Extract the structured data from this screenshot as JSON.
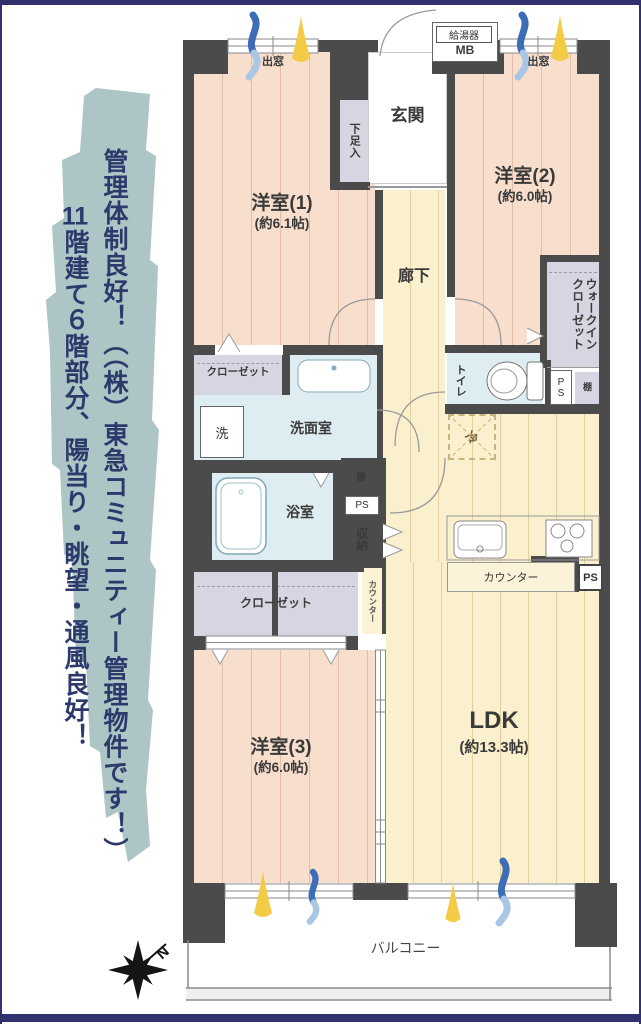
{
  "ad": {
    "line1": "管理体制良好！（（株）東急コミュニティー管理物件です！）",
    "line2_prefix": "11",
    "line2": "階建て６階部分、陽当り・眺望・通風良好！"
  },
  "plan": {
    "bay_window_left": "出窓",
    "bay_window_right": "出窓",
    "water_heater": "給湯器",
    "meter_box": "MB",
    "entrance": "玄関",
    "shoe_cabinet": "下足入",
    "room1_name": "洋室(1)",
    "room1_size": "(約6.1帖)",
    "room2_name": "洋室(2)",
    "room2_size": "(約6.0帖)",
    "room3_name": "洋室(3)",
    "room3_size": "(約6.0帖)",
    "corridor": "廊下",
    "wic_line1": "ウォークイン",
    "wic_line2": "クローゼット",
    "toilet": "トイレ",
    "ps_toilet": "PS",
    "shelf_right": "棚",
    "fridge": "冷",
    "closet_room1": "クローゼット",
    "washroom": "洗面室",
    "washer": "洗",
    "bathroom": "浴室",
    "shelf_left": "棚",
    "ps_bath": "PS",
    "storage": "収納",
    "counter_side": "カウンター",
    "closet_room3": "クローゼット",
    "kitchen_counter": "カウンター",
    "ps_kitchen": "PS",
    "ldk_name": "LDK",
    "ldk_size": "(約13.3帖)",
    "balcony": "バルコニー",
    "compass_north": "N"
  },
  "colors": {
    "wall": "#4b4b4b",
    "bedroom_floor": "#f8decd",
    "ldk_floor": "#faf0cd",
    "wet_floor": "#deedf2",
    "closet": "#d6d6e2",
    "brush": "#aec5c6",
    "ad_text": "#2c3a6b",
    "frame": "#31316e",
    "sun": "#f3cb45",
    "wind": "#3e6db8"
  }
}
